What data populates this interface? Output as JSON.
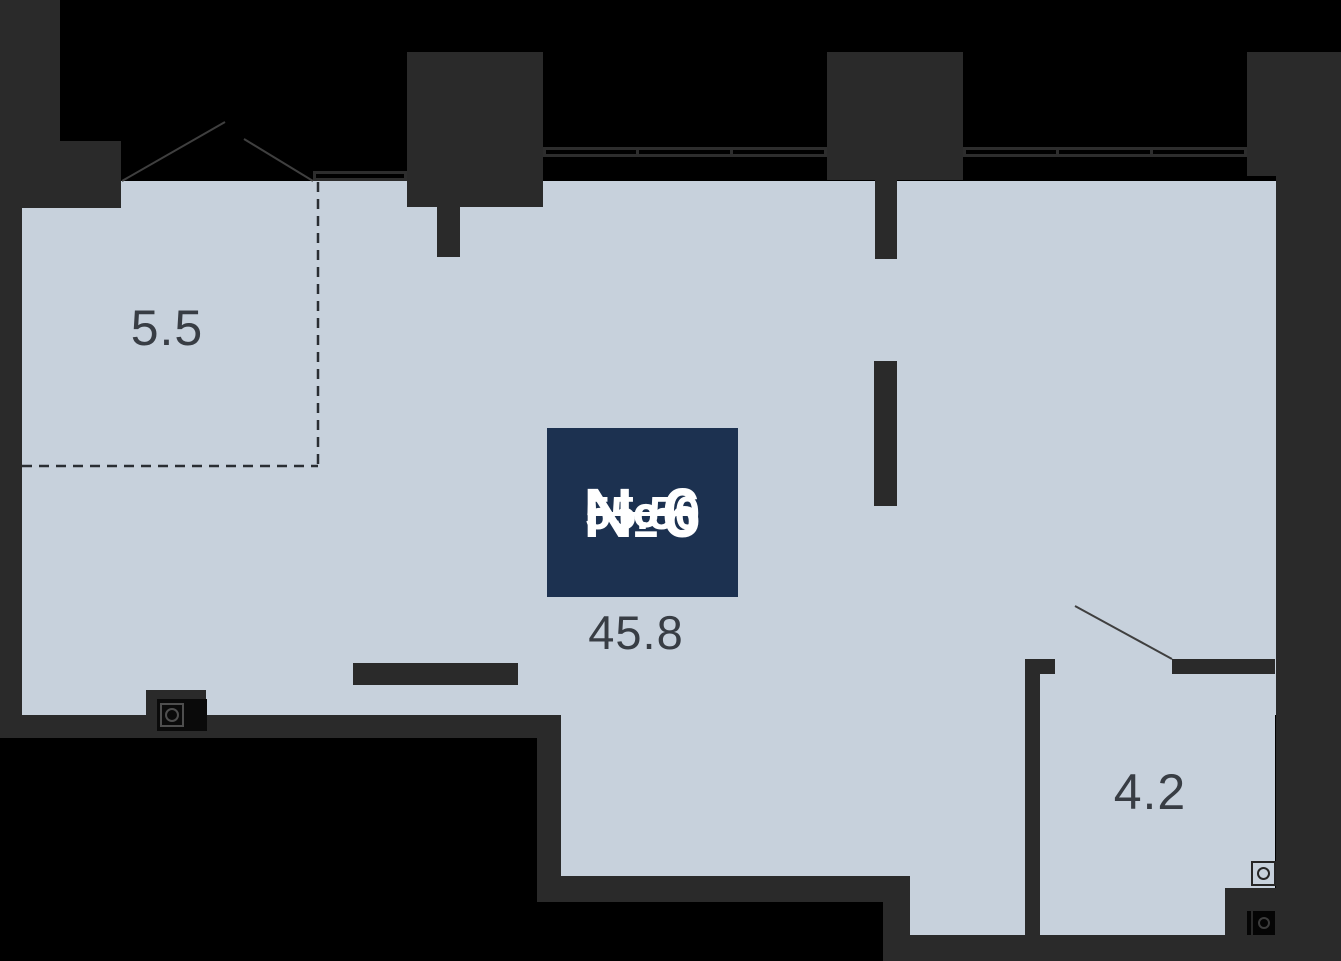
{
  "floorplan": {
    "unit": {
      "number_label": "№6",
      "area_label": "55.50"
    },
    "rooms": [
      {
        "name": "loggia",
        "area_label": "5.5"
      },
      {
        "name": "main-room",
        "area_label": "45.8"
      },
      {
        "name": "bathroom",
        "area_label": "4.2"
      }
    ],
    "icons": [
      "sink-appliance-icon",
      "washer-light-icon",
      "washer-dark-icon"
    ],
    "colors": {
      "outside": "#000000",
      "wall": "#2a2a2a",
      "floor": "#c7d1dc",
      "badge_background": "#1c3150",
      "badge_text": "#ffffff",
      "room_label_text": "#383d44",
      "door_line": "#3f3f3f",
      "dashed_line": "#2a2e33"
    }
  }
}
